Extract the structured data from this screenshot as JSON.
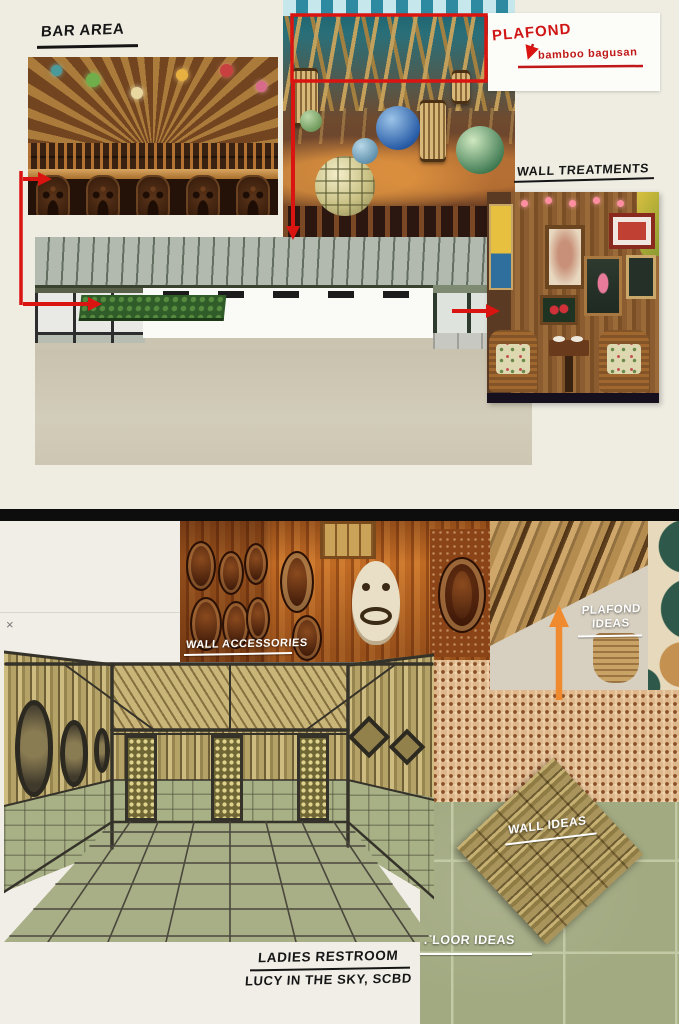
{
  "colors": {
    "annotation_red": "#da1410",
    "annotation_orange": "#f08a2e",
    "panel_background": "#efede2",
    "divider_black": "#0d0d0d"
  },
  "top_panel": {
    "bar_area_label": "BAR AREA",
    "plafond_note": "PLAFOND",
    "plafond_note_detail": "bamboo bagusan",
    "wall_treatments_label": "WALL TREATMENTS"
  },
  "bottom_panel": {
    "close_glyph": "×",
    "wall_accessories_label": "WALL ACCESSORIES",
    "plafond_ideas_label": "PLAFOND IDEAS",
    "wall_ideas_label": "WALL IDEAS",
    "floor_ideas_label": "FLOOR IDEAS",
    "restroom_title": "LADIES RESTROOM",
    "restroom_subtitle": "LUCY IN THE SKY, SCBD"
  }
}
